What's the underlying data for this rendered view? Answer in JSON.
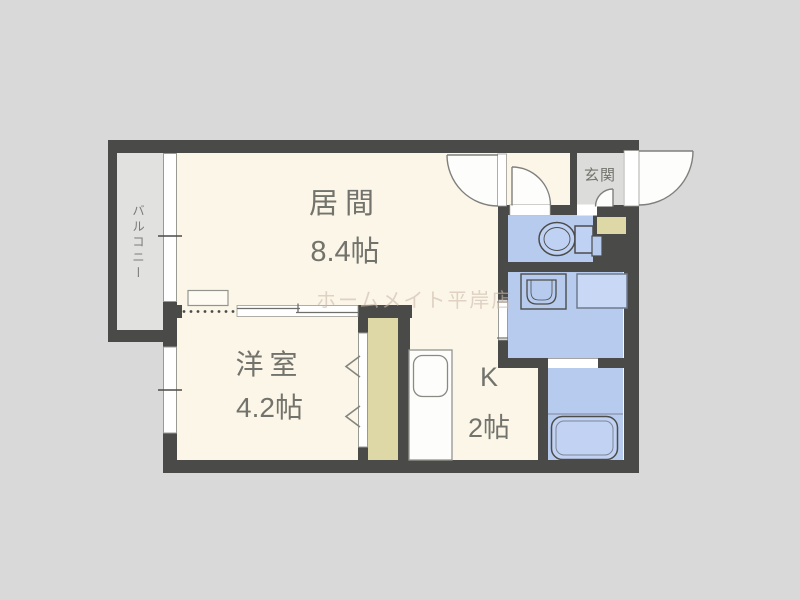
{
  "plan": {
    "type": "apartment-floor-plan",
    "rooms": {
      "living": {
        "name": "居間",
        "size": "8.4帖"
      },
      "western": {
        "name": "洋室",
        "size": "4.2帖"
      },
      "kitchen": {
        "name": "K",
        "size": "2帖"
      },
      "entrance": {
        "name": "玄関"
      },
      "balcony": {
        "name": "バルコニー"
      }
    },
    "fixtures": [
      "toilet",
      "washbasin",
      "washing-machine-pan",
      "bathtub",
      "kitchen-sink",
      "shoe-cabinet",
      "closet",
      "shelf"
    ],
    "watermark": "ホームメイト平岸店",
    "colors": {
      "background": "#d9d9d9",
      "floor": "#fbf6e7",
      "wall": "#4a4a48",
      "wet_area": "#b7cbee",
      "storage": "#ded7a6",
      "balcony_floor": "#e1e1df",
      "entrance_floor": "#dcdcda",
      "label_text": "#73736d",
      "watermark_text": "#cdbaae"
    }
  }
}
